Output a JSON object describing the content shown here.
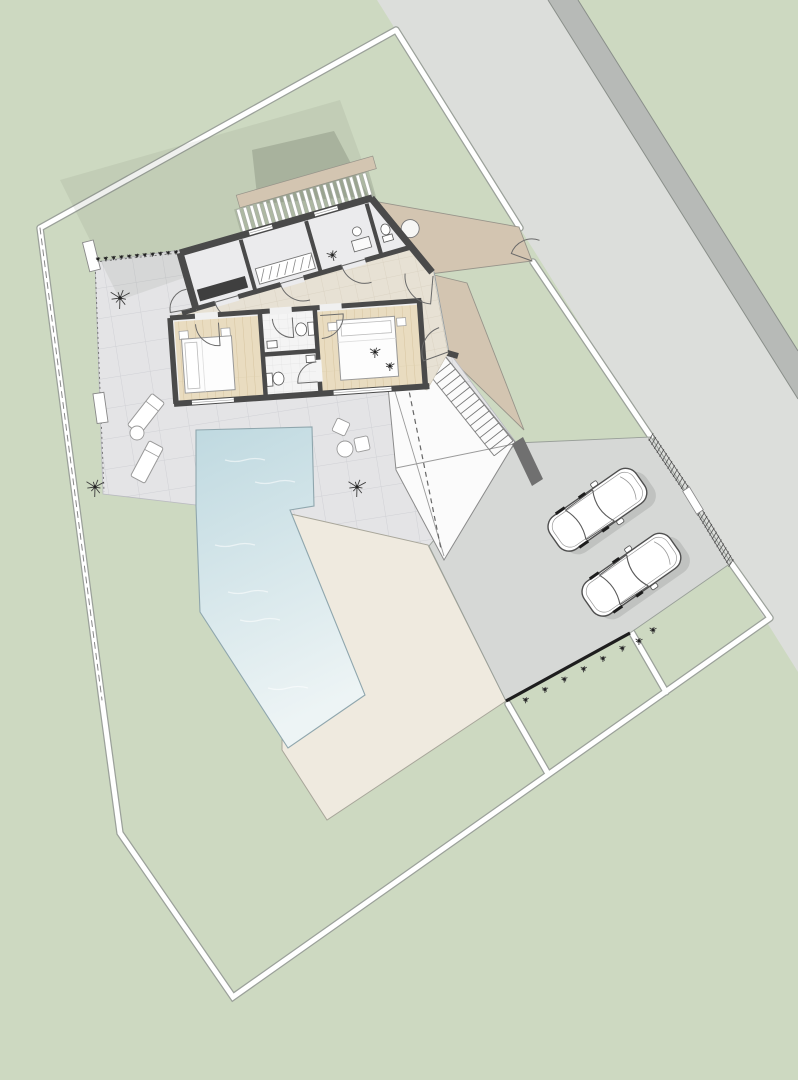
{
  "scene": {
    "type": "architectural-site-plan-top-view",
    "description": "Rotated site plan of a single-storey villa with terrace, pool, sun deck, carport with two parked cars, footpath to road, lawn and property boundary",
    "elements": [
      "road",
      "road-shoulder",
      "property-boundary",
      "footpath",
      "entry-gate",
      "terrace",
      "house",
      "hallway",
      "bedroom-1",
      "bedroom-2",
      "bathroom-1",
      "bathroom-2",
      "utility-rooms",
      "entry-wc",
      "pergola",
      "pool",
      "sun-deck",
      "garage-carport",
      "exterior-stairs",
      "driveway",
      "parked-cars",
      "garden-parcels",
      "shrubs",
      "loungers",
      "planters"
    ]
  },
  "counts": {
    "cars": 2,
    "parking_spaces": 2,
    "bedrooms": 2,
    "bathrooms": 2,
    "beds": 2,
    "toilets": 3,
    "sinks": 3,
    "loungers": 2,
    "side_tables": 2,
    "chairs": 2,
    "planters": 2,
    "stair_steps": 14,
    "pergola_slats": 20,
    "garden_parcels": 2,
    "large_shrubs": 3
  },
  "colors": {
    "grass": "#cdd9c1",
    "road": "#dcdedb",
    "road_shoulder": "#b7bab7",
    "boundary_white": "#ffffff",
    "boundary_edge": "#9ba19a",
    "path": "#d3c5b1",
    "path_edge": "#97948a",
    "terrace": "#e4e4e6",
    "terrace_line": "#d0d1d5",
    "deck": "#efeadf",
    "deck_edge": "#a8a69a",
    "pool_top": "#bfd9e0",
    "pool_bottom": "#edf4f5",
    "pool_edge": "#8fa6ad",
    "drive": "#d6d8d6",
    "drive_edge": "#999f99",
    "garage": "#fbfbfb",
    "wall": "#4a4a4a",
    "hall": "#e7e1d4",
    "hall_line": "#d8d0bf",
    "wood": "#e9dcc0",
    "wood_line": "#d6c5a0",
    "bath": "#f4f4f4",
    "bath_line": "#e2e2e2",
    "fixture": "#ffffff",
    "furniture_dark": "#3f3f3f",
    "car_body": "#ffffff",
    "car_line": "#4f4f4f",
    "black_wall": "#1e1e1e",
    "plant": "#3e3e3e",
    "shadow": "rgba(100,108,92,0.28)",
    "shadow_soft": "rgba(100,108,92,0.10)"
  }
}
